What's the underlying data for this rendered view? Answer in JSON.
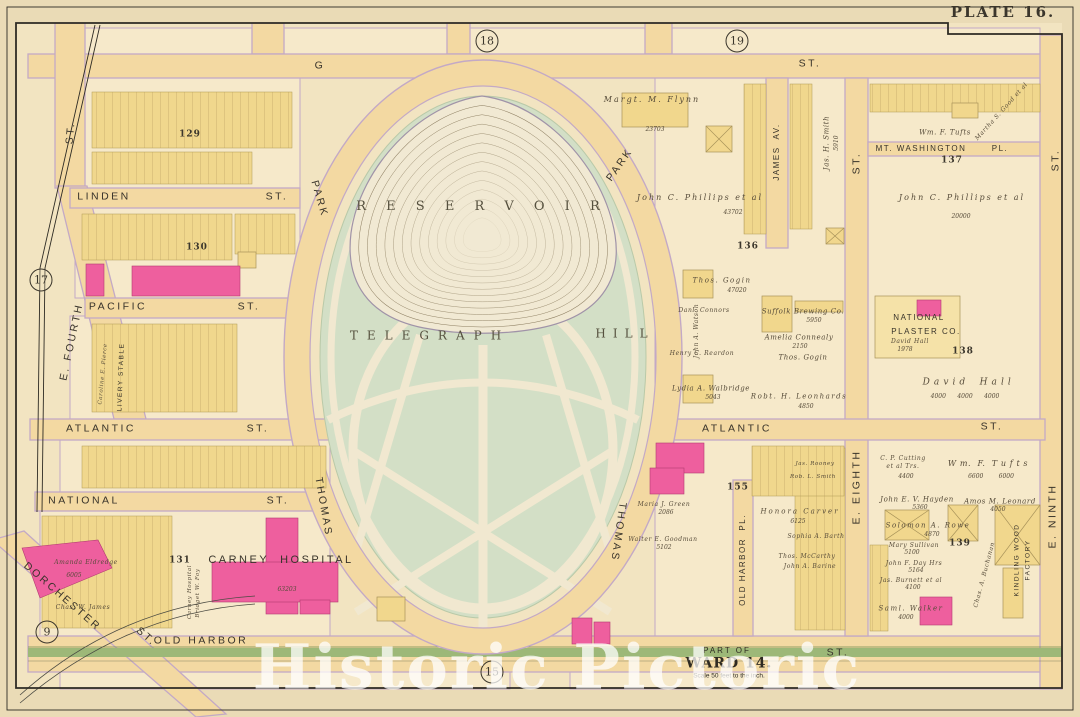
{
  "plate": {
    "title": "PLATE 16."
  },
  "watermark": "Historic Pictoric",
  "ward": {
    "part_of": "PART OF",
    "ward": "WARD 14.",
    "scale": "Scale 50 feet to the inch."
  },
  "colors": {
    "parchment": "#f2e4c1",
    "street_tan": "#f3d9a2",
    "street_edge": "#c3a9c6",
    "park_green": "#d3dfc6",
    "path_cream": "#f1e8d0",
    "lot_yellow": "#f0d78d",
    "building_pink": "#ee5f9e",
    "grass_green": "#9db878"
  },
  "streets": {
    "g": "G",
    "g_st": "ST.",
    "linden": "LINDEN",
    "linden_st": "ST.",
    "pacific": "PACIFIC",
    "pacific_st": "ST.",
    "atlantic_w": "ATLANTIC",
    "atlantic_w_st": "ST.",
    "national": "NATIONAL",
    "national_st": "ST.",
    "old_harbor": "OLD HARBOR",
    "old_harbor_st": "ST.",
    "e_fourth": "E. FOURTH",
    "left_st": "ST.",
    "dorchester": "DORCHESTER",
    "dorchester_st": "ST.",
    "park_nw": "PARK",
    "park_ne": "PARK",
    "thomas_sw": "THOMAS",
    "thomas_se": "THOMAS",
    "james_av": "JAMES  AV.",
    "e_eighth": "E. EIGHTH",
    "e_eighth_st": "ST.",
    "e_ninth": "E. NINTH",
    "e_ninth_st": "ST.",
    "old_harbor_pl": "OLD HARBOR  PL.",
    "mt_washington": "MT. WASHINGTON",
    "mt_washington_pl": "PL.",
    "atlantic_e": "ATLANTIC",
    "atlantic_e_st": "ST."
  },
  "blocks": {
    "c9": "9",
    "c15": "15",
    "c17": "17",
    "c18": "18",
    "c19": "19",
    "n129": "129",
    "n130": "130",
    "n131": "131",
    "n136": "136",
    "n137": "137",
    "n138": "138",
    "n139": "139",
    "n155": "155"
  },
  "places": {
    "reservoir": "R E S E R V O I R",
    "telegraph": "TELEGRAPH",
    "hill": "HILL",
    "carney": "CARNEY  HOSPITAL",
    "carney_no": "63203",
    "livery": "LIVERY STABLE",
    "plaster1": "NATIONAL",
    "plaster2": "PLASTER CO.",
    "kindling1": "KINDLING WOOD",
    "kindling2": "FACTORY"
  },
  "owners": {
    "flynn": {
      "n": "Margt. M. Flynn",
      "v": "23703"
    },
    "phillips_w": {
      "n": "John C. Phillips et al",
      "v": "43702"
    },
    "phillips_e": {
      "n": "John C. Phillips et al",
      "v": "20000"
    },
    "smith": {
      "n": "Jas. H. Smith",
      "v": "5910"
    },
    "martha": {
      "n": "Martha S. Good et al"
    },
    "tufts_n": {
      "n": "Wm. F. Tufts"
    },
    "gogin1": {
      "n": "Thos. Gogin",
      "v": "47020"
    },
    "suffolk": {
      "n": "Suffolk Brewing Co.",
      "v": "5950"
    },
    "connealy": {
      "n": "Amelia Connealy",
      "v": "2150"
    },
    "gogin2": {
      "n": "Thos. Gogin"
    },
    "connors": {
      "n": "Danl. Connors"
    },
    "watson": {
      "n": "John A. Watson"
    },
    "reardon": {
      "n": "Henry C. Reardon"
    },
    "walbridge": {
      "n": "Lydia A. Walbridge",
      "v": "5043"
    },
    "leonhards": {
      "n": "Robt. H. Leonhards",
      "v": "4850"
    },
    "hall_s": {
      "n": "David Hall",
      "v": "1978"
    },
    "hall_b": {
      "n": "D a v i d    H a l l",
      "v": "4000      4000      4000"
    },
    "cutting": {
      "n": "C. P. Cutting",
      "n2": "et al Trs.",
      "v": "4400"
    },
    "tufts_s": {
      "n": "W m.  F.  T u f t s",
      "v": "6600        6000"
    },
    "hayden": {
      "n": "John E. V. Hayden",
      "v": "5360"
    },
    "leonard": {
      "n": "Amos M. Leonard",
      "v": "4050"
    },
    "rowe": {
      "n": "Solomon A. Rowe",
      "v": "4870"
    },
    "sullivan": {
      "n": "Mary Sullivan",
      "v": "5100"
    },
    "day": {
      "n": "John F. Day Hrs",
      "v": "5164"
    },
    "burnett": {
      "n": "Jas. Burnett et al",
      "v": "4100"
    },
    "walker": {
      "n": "Saml. Walker",
      "v": "4000"
    },
    "buchanan": {
      "n": "Chas. A. Buchanan"
    },
    "carver": {
      "n": "Honora Carver",
      "v": "6125"
    },
    "green": {
      "n": "Maria J. Green",
      "v": "2086"
    },
    "goodman": {
      "n": "Walter E. Goodman",
      "v": "5102"
    },
    "barth": {
      "n": "Sophia A. Barth"
    },
    "mccarthy": {
      "n": "Thos. McCarthy"
    },
    "barine": {
      "n": "John A. Barine"
    },
    "rooney": {
      "n": "Jas. Rooney"
    },
    "smith_r": {
      "n": "Rob. L. Smith"
    },
    "eldredge": {
      "n": "Amanda Eldredge",
      "v": "6005"
    },
    "james_cw": {
      "n": "Chas. W. James"
    },
    "pierce": {
      "n": "Caroline E. Pierce"
    },
    "carney_v": {
      "n": "Carney Hospital",
      "n2": "Bridget W. Foy"
    }
  }
}
